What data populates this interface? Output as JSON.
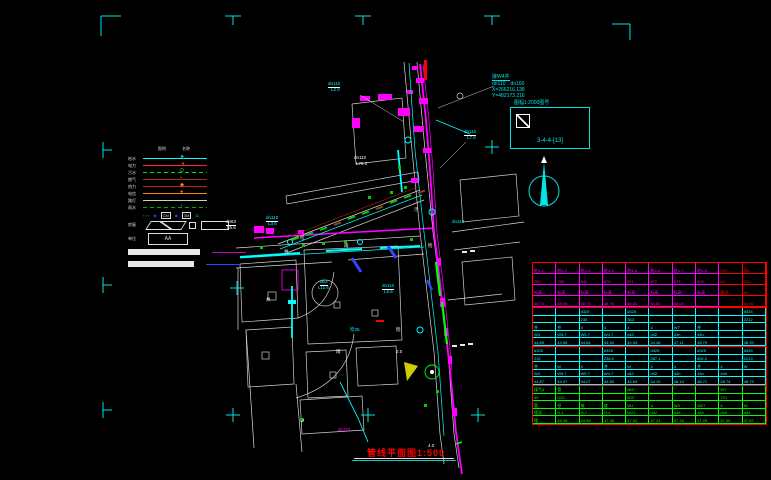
{
  "colors": {
    "accent_cyan": "#00e5e5",
    "accent_magenta": "#ff00ff",
    "accent_green": "#00ff00",
    "accent_red": "#ff0000",
    "white": "#e8e8e8"
  },
  "sheet": {
    "marks": [
      {
        "type": "corner-tl",
        "x": 101,
        "y": 16
      },
      {
        "type": "tick-down",
        "x": 233,
        "y": 16
      },
      {
        "type": "tick-down",
        "x": 363,
        "y": 16
      },
      {
        "type": "tick-down",
        "x": 492,
        "y": 16
      },
      {
        "type": "corner-tr",
        "x": 630,
        "y": 24
      },
      {
        "type": "tick-right",
        "x": 103,
        "y": 150
      },
      {
        "type": "tick-right",
        "x": 103,
        "y": 285
      },
      {
        "type": "tick-right",
        "x": 103,
        "y": 410
      },
      {
        "type": "cross",
        "x": 492,
        "y": 147
      },
      {
        "type": "cross",
        "x": 237,
        "y": 288
      },
      {
        "type": "cross",
        "x": 233,
        "y": 415
      },
      {
        "type": "cross",
        "x": 368,
        "y": 415
      },
      {
        "type": "cross",
        "x": 478,
        "y": 415
      }
    ]
  },
  "legend": {
    "headers": [
      "图例",
      "名称"
    ],
    "rows": [
      {
        "label": "给水",
        "color": "#00ffff",
        "marker": "➤",
        "marker_color": "#00ffff",
        "dashed": false
      },
      {
        "label": "电力",
        "color": "#ff2222",
        "marker": "◄",
        "marker_color": "#ff2222",
        "dashed": false
      },
      {
        "label": "污水",
        "color": "#00dd00",
        "marker": "Ω",
        "marker_color": "#00ff00",
        "dashed": true
      },
      {
        "label": "燃气",
        "color": "#993322",
        "marker": "▪",
        "marker_color": "#cc4422",
        "dashed": false
      },
      {
        "label": "热力",
        "color": "#cc2222",
        "marker": "◆",
        "marker_color": "#ff8800",
        "dashed": false
      },
      {
        "label": "电信",
        "color": "#ff8800",
        "marker": "●",
        "marker_color": "#ff8800",
        "dashed": false
      },
      {
        "label": "路灯",
        "color": "#cccccc",
        "marker": "",
        "marker_color": "#ffffff",
        "dashed": false
      },
      {
        "label": "雨水",
        "color": "#00aa00",
        "marker": "+",
        "marker_color": "#3344ff",
        "dashed": true
      }
    ],
    "symbols": [
      {
        "text": "▪ ▪ ▪",
        "color": "#00aa00",
        "box": false
      },
      {
        "text": "◆",
        "color": "#3344ff",
        "box": false
      },
      {
        "text": "CM",
        "color": "#dddddd",
        "box": true
      },
      {
        "text": "◆",
        "color": "#3344ff",
        "box": false
      },
      {
        "text": "3M",
        "color": "#dddddd",
        "box": true
      },
      {
        "text": "Ω",
        "color": "#00ff00",
        "box": false
      }
    ],
    "house_label": "房屋",
    "unit_label": "单位",
    "unit_box_text": "AA",
    "scale_bars": [
      {
        "bar_width": 72,
        "line_color": "#cc00cc"
      },
      {
        "bar_width": 66,
        "line_color": "#3344ff"
      }
    ]
  },
  "annotations": {
    "coord_block": [
      "接W4井",
      "dn110→dn160",
      "X=266216.138",
      "Y=482173.216"
    ],
    "detail_box": {
      "title": "图幅1:2000图号",
      "ref": "3-4-4-[13]"
    }
  },
  "map": {
    "labels": [
      {
        "t": "dn110",
        "x": 328,
        "y": 82,
        "c": "#00ffff",
        "u": true
      },
      {
        "t": "L2.0",
        "x": 331,
        "y": 88,
        "c": "#00ffff",
        "u": false
      },
      {
        "t": "dn110",
        "x": 464,
        "y": 130,
        "c": "#00ffff",
        "u": true
      },
      {
        "t": "L7.0",
        "x": 467,
        "y": 136,
        "c": "#00ffff",
        "u": false
      },
      {
        "t": "dn110",
        "x": 354,
        "y": 156,
        "c": "#ffffff",
        "u": false
      },
      {
        "t": "L79.0",
        "x": 356,
        "y": 162,
        "c": "#ffffff",
        "u": false
      },
      {
        "t": "dn63",
        "x": 226,
        "y": 220,
        "c": "#ffffff",
        "u": true
      },
      {
        "t": "L5.6",
        "x": 227,
        "y": 226,
        "c": "#ffffff",
        "u": false
      },
      {
        "t": "dn110",
        "x": 266,
        "y": 216,
        "c": "#00ffff",
        "u": true
      },
      {
        "t": "L3.6",
        "x": 268,
        "y": 222,
        "c": "#00ffff",
        "u": false
      },
      {
        "t": "d63",
        "x": 320,
        "y": 280,
        "c": "#00ffff",
        "u": true
      },
      {
        "t": "L11.6",
        "x": 318,
        "y": 286,
        "c": "#00ffff",
        "u": false
      },
      {
        "t": "dn110",
        "x": 382,
        "y": 284,
        "c": "#00ffff",
        "u": true
      },
      {
        "t": "L5.6",
        "x": 384,
        "y": 290,
        "c": "#00ffff",
        "u": false
      },
      {
        "t": "dn110",
        "x": 452,
        "y": 220,
        "c": "#00ffff",
        "u": false
      },
      {
        "t": "检25",
        "x": 350,
        "y": 328,
        "c": "#00ffff",
        "u": false
      },
      {
        "t": "dn110",
        "x": 338,
        "y": 428,
        "c": "#ff00ff",
        "u": false
      },
      {
        "t": "检",
        "x": 300,
        "y": 236,
        "c": "#ffffff",
        "u": false
      },
      {
        "t": "雨",
        "x": 344,
        "y": 244,
        "c": "#ffffff",
        "u": false
      },
      {
        "t": "污",
        "x": 414,
        "y": 208,
        "c": "#ffffff",
        "u": false
      },
      {
        "t": "井",
        "x": 284,
        "y": 250,
        "c": "#ffffff",
        "u": false
      },
      {
        "t": "检",
        "x": 428,
        "y": 244,
        "c": "#ffffff",
        "u": false
      },
      {
        "t": "雨",
        "x": 336,
        "y": 350,
        "c": "#ffffff",
        "u": false
      },
      {
        "t": "井",
        "x": 266,
        "y": 298,
        "c": "#ffffff",
        "u": false
      },
      {
        "t": "检",
        "x": 396,
        "y": 328,
        "c": "#ffffff",
        "u": false
      },
      {
        "t": "2.0",
        "x": 396,
        "y": 350,
        "c": "#ffffff",
        "u": false
      },
      {
        "t": "4.0",
        "x": 428,
        "y": 444,
        "c": "#ffffff",
        "u": false
      }
    ]
  },
  "table": {
    "groups": [
      {
        "color": "#ff00ff",
        "red_from": 8,
        "red_color": "#ff0000",
        "rows": [
          [
            "桩4-1",
            "桩4-2",
            "桩4-3",
            "桩4-4",
            "桩4-5",
            "桩4-6",
            "桩4-7",
            "桩4-8",
            "P62",
            "雨1"
          ],
          [
            "757",
            "765",
            "842",
            "870",
            "871",
            "872",
            "873",
            "874",
            "84",
            "211"
          ],
          [
            "标高",
            "标高",
            "标高",
            "标高",
            "标高",
            "标高",
            "标高",
            "标高",
            "管径",
            "64"
          ],
          [
            "48.74",
            "48.63",
            "48.73",
            "48.76",
            "48.81",
            "44.82",
            "43.04",
            "",
            "",
            "44.60"
          ]
        ]
      },
      {
        "color": "#00ffff",
        "rows": [
          [
            "",
            "",
            "d325",
            "",
            "d325",
            "",
            "",
            "",
            "",
            "d325"
          ],
          [
            "",
            "",
            "234",
            "",
            "363",
            "",
            "",
            "",
            "",
            "2212"
          ],
          [
            "井",
            "井",
            "4",
            "4",
            "4",
            "4",
            "W7",
            "井",
            "",
            ""
          ],
          [
            "W4",
            "W5.7",
            "W5.7",
            "W4.7",
            "d42",
            "d42",
            "44n",
            "44n",
            "",
            ""
          ],
          [
            "44.85",
            "44.55",
            "44.84",
            "44.94",
            "44.94",
            "44.48",
            "47.11",
            "48.79",
            "",
            "48.39"
          ]
        ]
      },
      {
        "color": "#00ffff",
        "rows": [
          [
            "d325",
            "",
            "",
            "d325",
            "",
            "d325",
            "",
            "d325",
            "",
            "d325"
          ],
          [
            "232",
            "",
            "",
            "238.0",
            "",
            "387.1",
            "",
            "852.2",
            "",
            "2213"
          ],
          [
            "井",
            "W",
            "4",
            "井",
            "W",
            "4",
            "4",
            "井",
            "4",
            "W"
          ],
          [
            "W4",
            "W5.7",
            "W5.7",
            "W4.7",
            "d42",
            "d42",
            "44n",
            "44n",
            "44n",
            ""
          ],
          [
            "44.87",
            "44.47",
            "44.07",
            "44.83",
            "44.63",
            "44.10",
            "48.10",
            "48.71",
            "48.74",
            "48.79"
          ]
        ]
      },
      {
        "color": "#00ff00",
        "rows": [
          [
            "煤气4",
            "管",
            "",
            "",
            "d63",
            "",
            "",
            "",
            "W7",
            ""
          ],
          [
            "45",
            "D20",
            "",
            "",
            "502",
            "",
            "",
            "",
            "721",
            ""
          ],
          [
            "管",
            "径",
            "坡",
            "度",
            "W1",
            "4",
            "W0",
            "W27",
            "4",
            "W"
          ],
          [
            "埋深",
            "H-1",
            "H-1",
            "H-4",
            "W21",
            "d42",
            "d48",
            "d44",
            "d44",
            "d44"
          ],
          [
            "埋",
            "48.45",
            "44.98",
            "47.28",
            "47.02",
            "47.24",
            "47.34",
            "47.29",
            "47.49",
            "47.87"
          ]
        ]
      }
    ]
  },
  "footer": {
    "title": "管线平面图1:500"
  }
}
